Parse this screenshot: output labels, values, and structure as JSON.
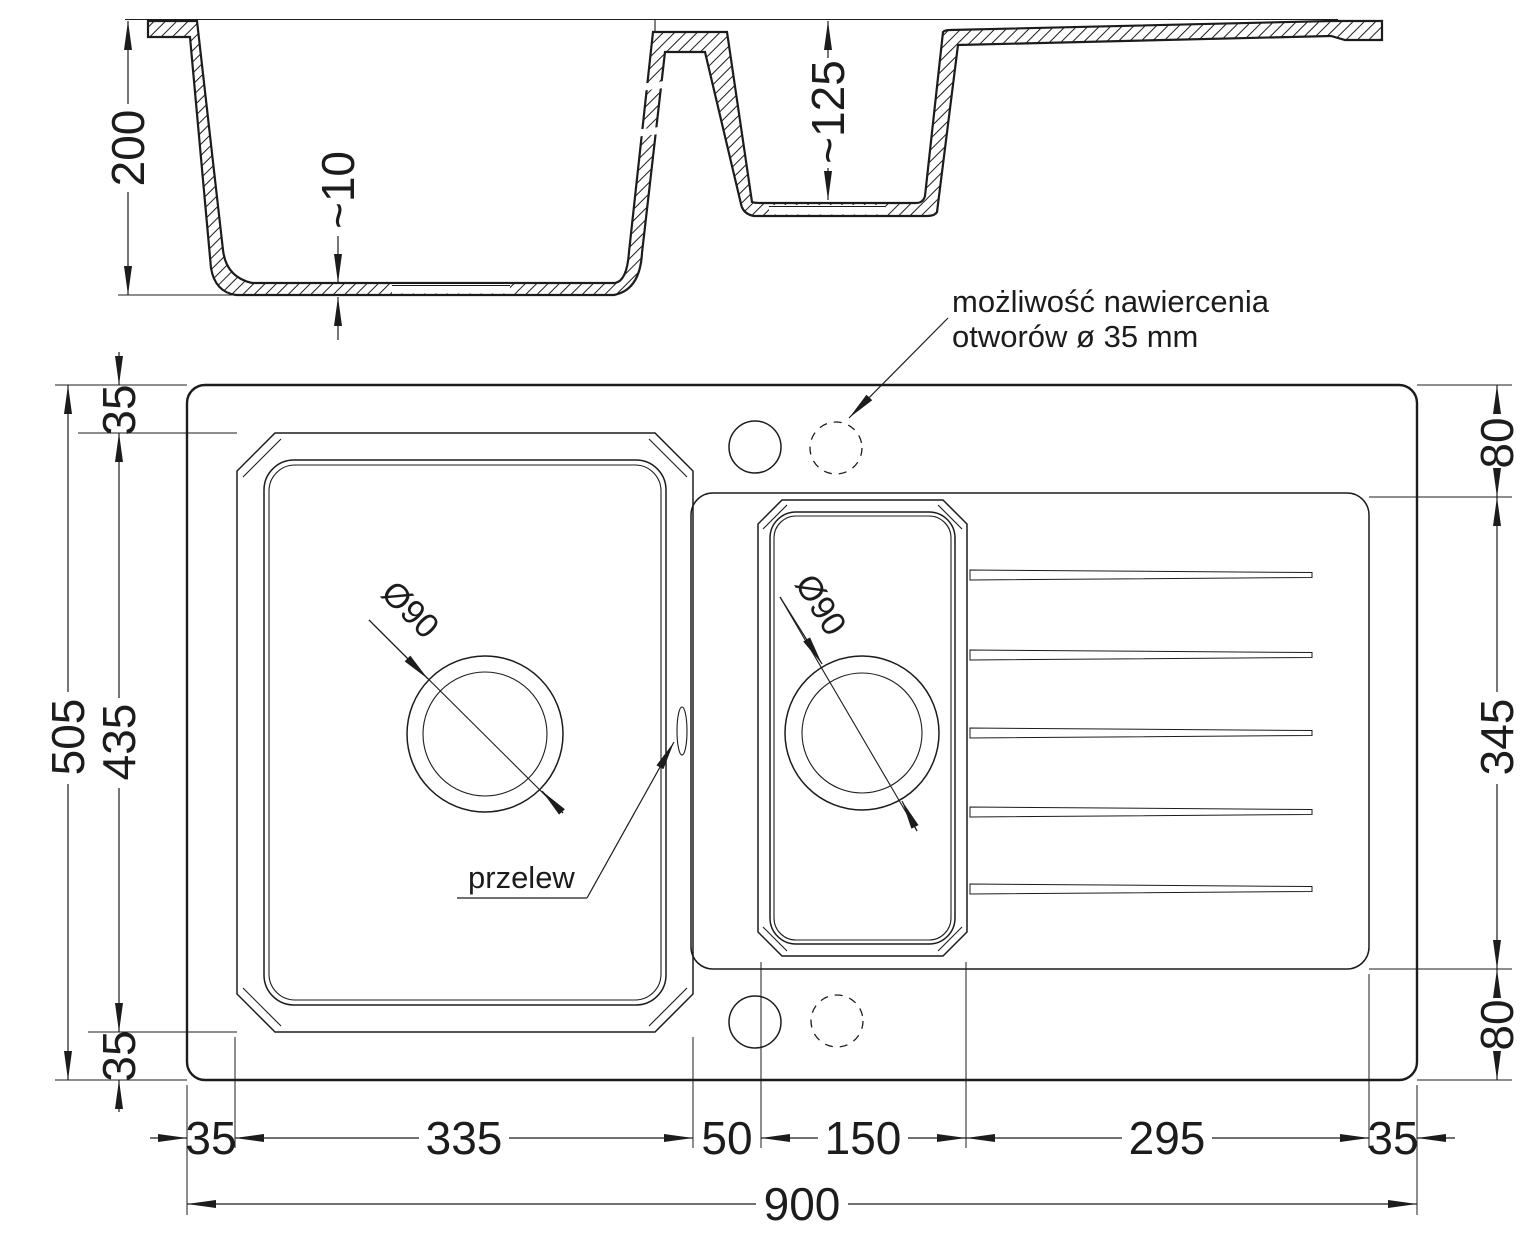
{
  "section": {
    "depth_main": "200",
    "floor_thickness": "~10",
    "depth_small": "~125"
  },
  "plan": {
    "total_width": "900",
    "total_height": "505",
    "left": {
      "top": "35",
      "bowl": "435",
      "bottom": "35"
    },
    "right": {
      "top": "80",
      "middle": "345",
      "bottom": "80"
    },
    "bottom": [
      "35",
      "335",
      "50",
      "150",
      "295",
      "35"
    ],
    "drain_main": "Ø90",
    "drain_small": "Ø90",
    "overflow": "przelew"
  },
  "notes": {
    "drill1": "możliwość nawiercenia",
    "drill2": "otworów ø 35 mm"
  },
  "colors": {
    "line": "#1c1c1c",
    "bg": "#ffffff"
  }
}
